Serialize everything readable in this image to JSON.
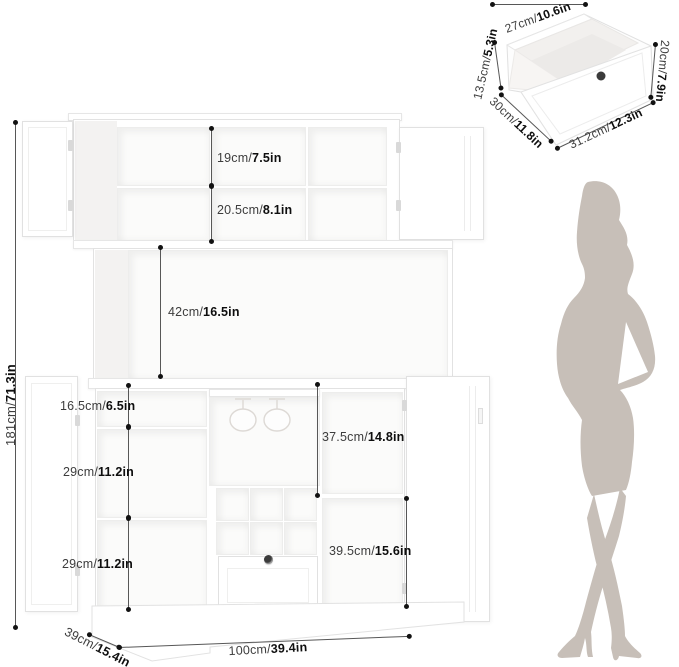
{
  "title": "Bar cabinet dimension diagram",
  "colors": {
    "silhouette": "#c7bfb8",
    "dimension_line": "#575757",
    "dimension_dot": "#121212",
    "cabinet_edge": "#e2e2e2",
    "knob": "#3b3b3b"
  },
  "cabinet_dims": {
    "total_height": {
      "cm": "181cm/",
      "in": "71.3in"
    },
    "hutch_upper": {
      "cm": "19cm/",
      "in": "7.5in"
    },
    "hutch_lower": {
      "cm": "20.5cm/",
      "in": "8.1in"
    },
    "middle_open": {
      "cm": "42cm/",
      "in": "16.5in"
    },
    "left_top": {
      "cm": "16.5cm/",
      "in": "6.5in"
    },
    "left_mid": {
      "cm": "29cm/",
      "in": "11.2in"
    },
    "left_bottom": {
      "cm": "29cm/",
      "in": "11.2in"
    },
    "right_upper": {
      "cm": "37.5cm/",
      "in": "14.8in"
    },
    "right_lower": {
      "cm": "39.5cm/",
      "in": "15.6in"
    },
    "base_depth": {
      "cm": "39cm/",
      "in": "15.4in"
    },
    "base_width": {
      "cm": "100cm/",
      "in": "39.4in"
    }
  },
  "drawer_detail": {
    "width_top": {
      "cm": "27cm/",
      "in": "10.6in"
    },
    "height_left": {
      "cm": "13.5cm/",
      "in": "5.3in"
    },
    "depth_side": {
      "cm": "30cm/",
      "in": "11.8in"
    },
    "height_right": {
      "cm": "20cm/",
      "in": "7.9in"
    },
    "width_bottom": {
      "cm": "31.2cm/",
      "in": "12.3in"
    }
  }
}
